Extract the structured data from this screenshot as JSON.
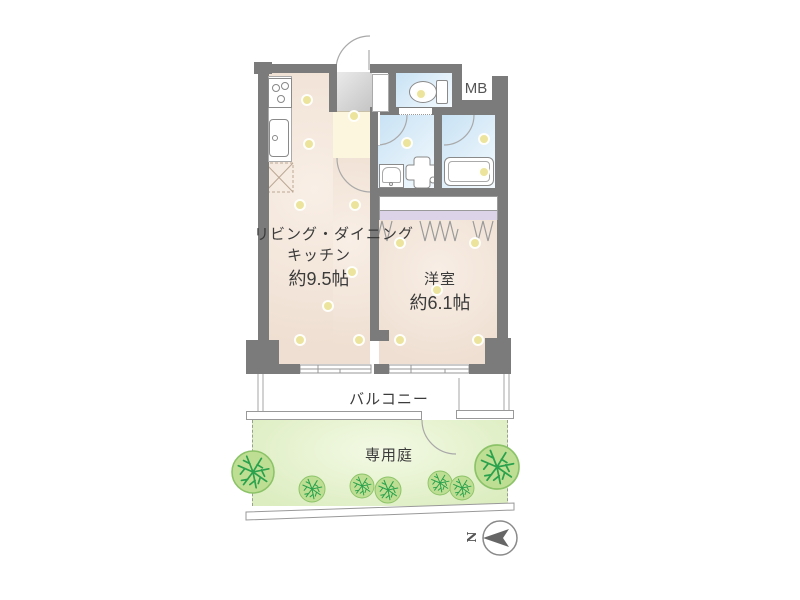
{
  "rooms": {
    "ldk": {
      "name": "リビング・ダイニング",
      "name2": "キッチン",
      "size": "約9.5帖"
    },
    "bedroom": {
      "name": "洋室",
      "size": "約6.1帖"
    },
    "balcony": {
      "name": "バルコニー"
    },
    "garden": {
      "name": "専用庭"
    },
    "meter_box": {
      "name": "MB"
    }
  },
  "compass": {
    "north_label": "N"
  },
  "colors": {
    "wall": "#7b7b7b",
    "floor": "#f1e3d8",
    "wet": "#cfe6f6",
    "hall": "#fcf6df",
    "closet": "#ddd3e8",
    "garden": "#dcedc0",
    "tree": "#bedf93",
    "tree_branch": "#2aa14c",
    "accent_dot": "#ece49c"
  }
}
